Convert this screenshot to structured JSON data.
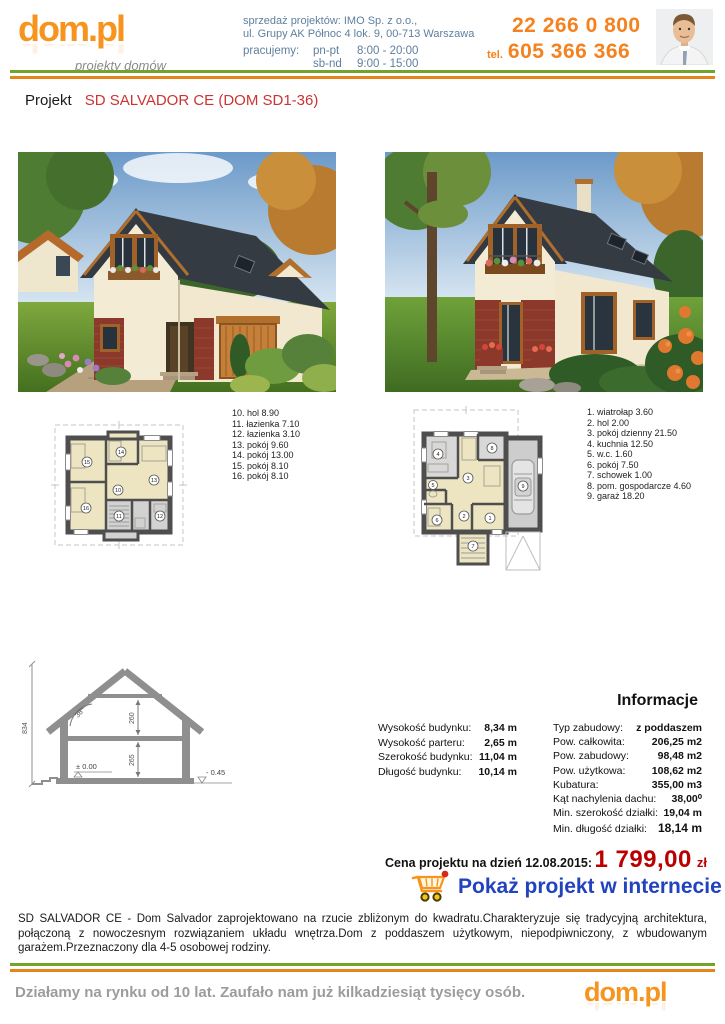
{
  "brand": {
    "logo_text": "dom.pl",
    "logo_tagline": "projekty domów"
  },
  "header": {
    "sales_line1": "sprzedaż projektów: IMO Sp. z o.o.,",
    "sales_line2": "ul. Grupy AK Północ 4 lok. 9, 00-713 Warszawa",
    "hours_label": "pracujemy:",
    "hours": [
      {
        "days": "pn-pt",
        "time": "8:00 - 20:00"
      },
      {
        "days": "sb-nd",
        "time": "9:00 - 15:00"
      }
    ],
    "phone_primary": "22 266 0 800",
    "phone_tel_label": "tel.",
    "phone_secondary": "605 366 366"
  },
  "title": {
    "prefix": "Projekt",
    "name": "SD SALVADOR CE (DOM SD1-36)"
  },
  "plans": {
    "upper": {
      "rooms": [
        "10. hol 8.90",
        "11. łazienka 7.10",
        "12. łazienka 3.10",
        "13. pokój 9.60",
        "14. pokój 13.00",
        "15. pokój 8.10",
        "16. pokój 8.10"
      ],
      "badges": [
        "10",
        "11",
        "12",
        "13",
        "14",
        "15",
        "16"
      ]
    },
    "ground": {
      "rooms": [
        "1. wiatrołap 3.60",
        "2. hol 2.00",
        "3. pokój dzienny 21.50",
        "4. kuchnia 12.50",
        "5. w.c. 1.60",
        "6. pokój 7.50",
        "7. schowek 1.00",
        "8. pom. gospodarcze 4.60",
        "9. garaż 18.20"
      ],
      "badges": [
        "1",
        "2",
        "3",
        "4",
        "5",
        "6",
        "7",
        "8",
        "9"
      ]
    }
  },
  "cross_section": {
    "height_total": "834",
    "roof_angle": "38°",
    "attic_height": "260",
    "parter_height": "265",
    "level_zero": "± 0.00",
    "level_minus": "- 0.45"
  },
  "info": {
    "heading": "Informacje",
    "left_rows": [
      {
        "label": "Wysokość budynku:",
        "value": "8,34 m"
      },
      {
        "label": "Wysokość parteru:",
        "value": "2,65 m"
      },
      {
        "label": "Szerokość budynku:",
        "value": "11,04 m"
      },
      {
        "label": "Długość budynku:",
        "value": "10,14 m"
      }
    ],
    "right_rows": [
      {
        "label": "Typ zabudowy:",
        "value": "z poddaszem"
      },
      {
        "label": "Pow. całkowita:",
        "value": "206,25 m2"
      },
      {
        "label": "Pow. zabudowy:",
        "value": "98,48 m2"
      },
      {
        "label": "Pow. użytkowa:",
        "value": "108,62 m2"
      },
      {
        "label": "Kubatura:",
        "value": "355,00 m3"
      },
      {
        "label": "Kąt nachylenia dachu:",
        "value": "38,00⁰"
      },
      {
        "label": "Min. szerokość działki:",
        "value": "19,04 m"
      },
      {
        "label": "Min. długość działki:",
        "value": "18,14 m"
      }
    ]
  },
  "price": {
    "label": "Cena projektu na dzień 12.08.2015:",
    "amount": "1 799,00",
    "currency": "zł"
  },
  "cta": {
    "label": "Pokaż projekt w internecie"
  },
  "description": "SD SALVADOR CE - Dom Salvador zaprojektowano na rzucie zbliżonym do kwadratu.Charakteryzuje się tradycyjną architektura, połączoną z nowoczesnym rozwiązaniem układu wnętrza.Dom z poddaszem użytkowym, niepodpiwniczony, z wbudowanym garażem.Przeznaczony dla 4-5 osobowej rodziny.",
  "footer": {
    "text": "Działamy na rynku od 10 lat. Zaufało nam już kilkadziesiąt tysięcy osób.",
    "logo_text": "dom.pl"
  },
  "colors": {
    "brand_orange": "#F7941E",
    "line_green": "#72A42C",
    "line_orange": "#E8821A",
    "accent_red": "#CC3333",
    "price_red": "#BB0000",
    "cta_blue": "#2143BE",
    "contact_blue": "#5E7F9F"
  }
}
